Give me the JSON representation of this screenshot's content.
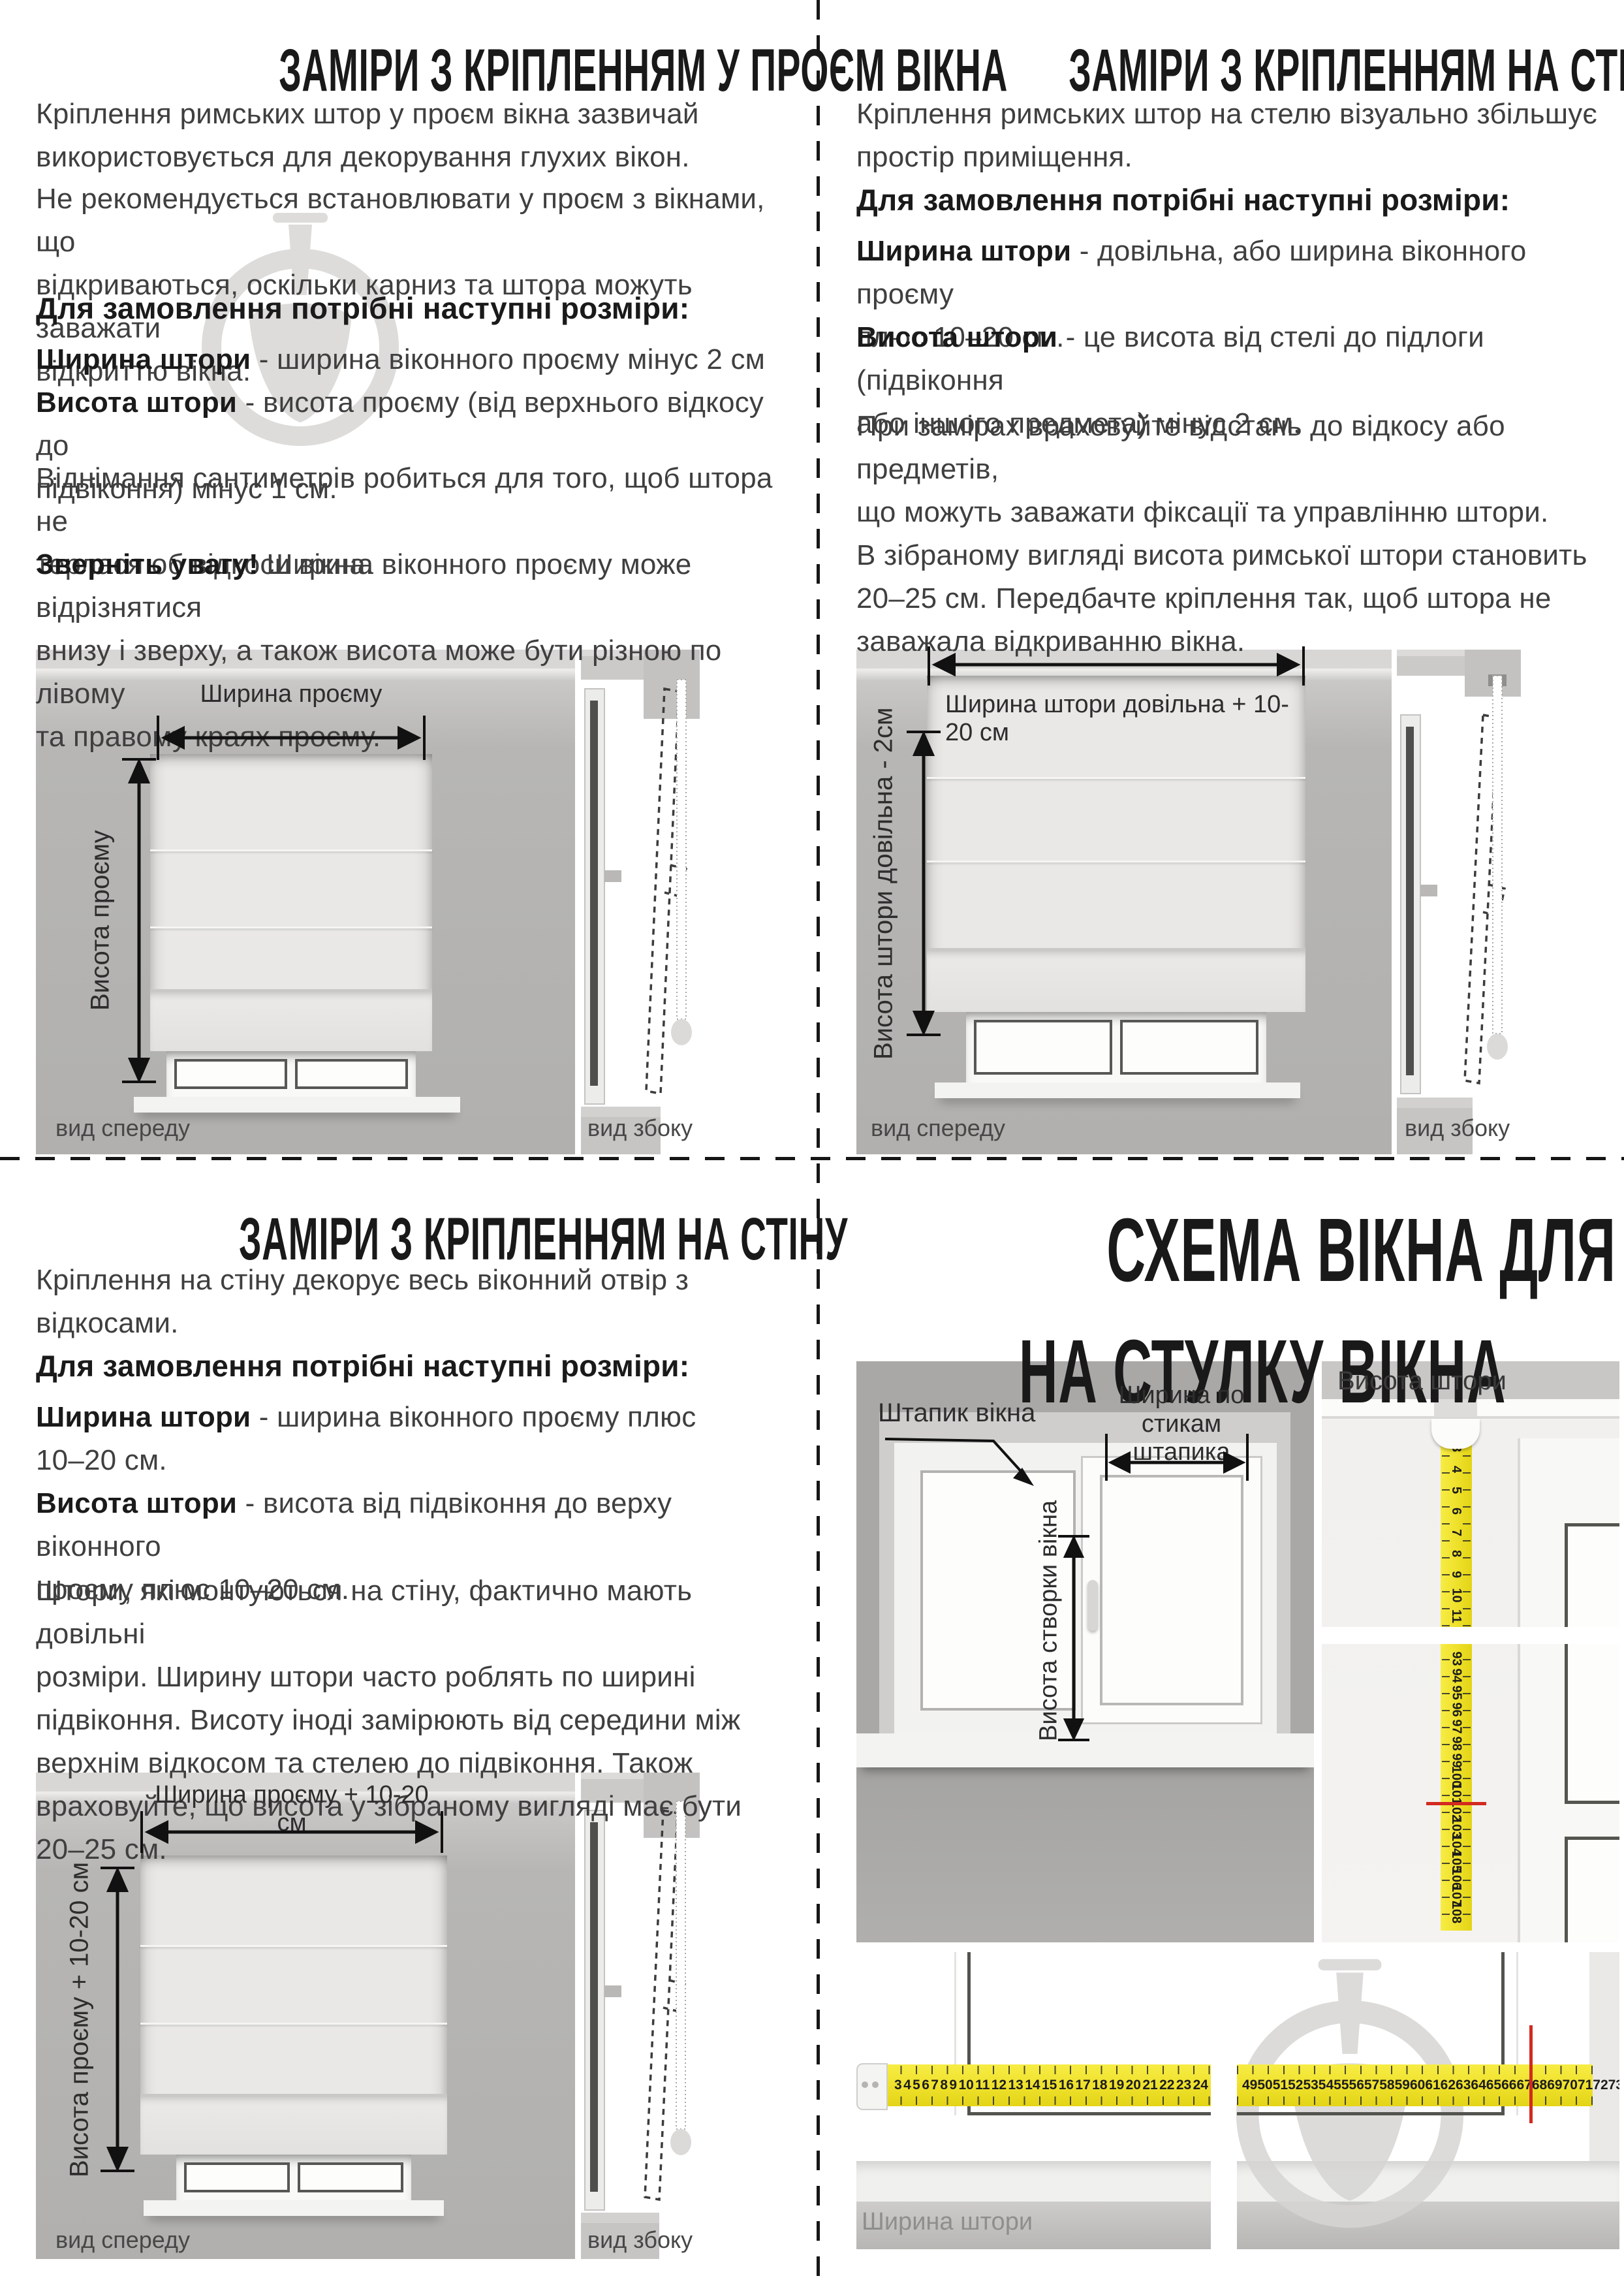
{
  "colors": {
    "tape_yellow": "#eee02a",
    "mark_red": "#d32a1f",
    "photo_wall_grey": "#b3b2b0",
    "schematic_wall_grey": "#a9a8a6",
    "watermark_grey": "#dddcda",
    "text_dark": "#1a1a1a"
  },
  "quad_tl": {
    "title": "ЗАМІРИ З КРІПЛЕННЯМ У ПРОЄМ ВІКНА",
    "para1": "Кріплення римських штор у проєм вікна зазвичай\nвикористовується для декорування глухих вікон.",
    "para2": "Не рекомендується встановлювати у проєм з вікнами, що\nвідкриваються, оскільки карниз та штора можуть заважати\nвідкриттю вікна.",
    "order_heading": "Для замовлення потрібні наступні розміри:",
    "width_label": "Ширина штори",
    "width_text": " - ширина віконного проєму мінус 2 см",
    "height_label": "Висота штори",
    "height_text": " - висота проєму (від верхнього відкосу до\nпідвіконня) мінус 1 см.",
    "para3": "Віднімання сантиметрів робиться для того, щоб штора не\nтерлася об відкоси вікна.",
    "note_label": "Зверніть увагу!",
    "note_text": " Ширина віконного проєму може відрізнятися\nвнизу і зверху, а також висота може бути різною по лівому\nта правому краях проєму.",
    "diagram": {
      "width_arrow_label": "Ширина проєму",
      "height_arrow_label": "Висота проєму",
      "front_caption": "вид спереду",
      "side_caption": "вид збоку"
    }
  },
  "quad_tr": {
    "title": "ЗАМІРИ З КРІПЛЕННЯМ НА СТЕЛЮ",
    "para1": "Кріплення римських штор на стелю візуально збільшує\nпростір приміщення.",
    "order_heading": "Для замовлення потрібні наступні розміри:",
    "width_label": "Ширина штори",
    "width_text": " - довільна, або ширина віконного проєму\nплюс 10–20 см.",
    "height_label": "Висота штори",
    "height_text": " - це висота від стелі до підлоги (підвіконня\nабо іншого предмета) мінус 2 см.",
    "para2": "При замірах враховуйте відстань до відкосу або предметів,\nщо можуть заважати фіксації та управлінню штори.\nВ зібраному вигляді висота римської штори становить\n20–25 см. Передбачте кріплення так, щоб штора не\nзаважала відкриванню вікна.",
    "diagram": {
      "width_arrow_label": "Ширина штори довільна + 10-20 см",
      "height_arrow_label": "Висота штори довільна - 2см",
      "front_caption": "вид спереду",
      "side_caption": "вид збоку"
    }
  },
  "quad_bl": {
    "title": "ЗАМІРИ З КРІПЛЕННЯМ НА СТІНУ",
    "para1": "Кріплення на стіну декорує весь віконний отвір з\nвідкосами.",
    "order_heading": "Для замовлення потрібні наступні розміри:",
    "width_label": "Ширина штори",
    "width_text": " - ширина віконного проєму плюс\n10–20 см.",
    "height_label": "Висота штори",
    "height_text": " - висота від підвіконня до верху віконного\nпроєму плюс 10–20 см.",
    "para2": "Штори, які монтуються на стіну, фактично мають довільні\nрозміри. Ширину штори часто роблять по ширині\nпідвіконня. Висоту іноді замірюють від середини між\nверхнім відкосом та стелею до підвіконня. Також\nвраховуйте, що висота у зібраному вигляді має бути\n20–25 см.",
    "diagram": {
      "width_arrow_label": "Ширина проєму + 10-20 см",
      "height_arrow_label": "Висота проєму + 10-20 см",
      "front_caption": "вид спереду",
      "side_caption": "вид збоку"
    }
  },
  "quad_br": {
    "title_line1": "СХЕМА ВІКНА ДЛЯ ЗАМІРІВ",
    "title_line2": "НА СТУЛКУ ВІКНА",
    "bead_label": "Штапик вікна",
    "bead_width_line1": "Ширина по стикам",
    "bead_width_line2": "штапика",
    "sash_height_label": "Висота створки вікна",
    "curtain_height_label": "Висота штори",
    "curtain_width_label": "Ширина штори",
    "vertical_tape": {
      "top_numbers": [
        3,
        4,
        5,
        6,
        7,
        8,
        9,
        10,
        11
      ],
      "bottom_numbers": [
        93,
        94,
        95,
        96,
        97,
        98,
        99,
        100,
        101,
        102,
        103,
        104,
        105,
        106,
        107,
        108
      ]
    },
    "horizontal_tape": {
      "left_numbers": [
        3,
        4,
        5,
        6,
        7,
        8,
        9,
        10,
        11,
        12,
        13,
        14,
        15,
        16,
        17,
        18,
        19,
        20,
        21,
        22,
        23,
        24
      ],
      "right_numbers": [
        49,
        50,
        51,
        52,
        53,
        54,
        55,
        56,
        57,
        58,
        59,
        60,
        61,
        62,
        63,
        64,
        65,
        66,
        67,
        68,
        69,
        70,
        71,
        72,
        73,
        74,
        75,
        76,
        77,
        78,
        79
      ]
    }
  }
}
